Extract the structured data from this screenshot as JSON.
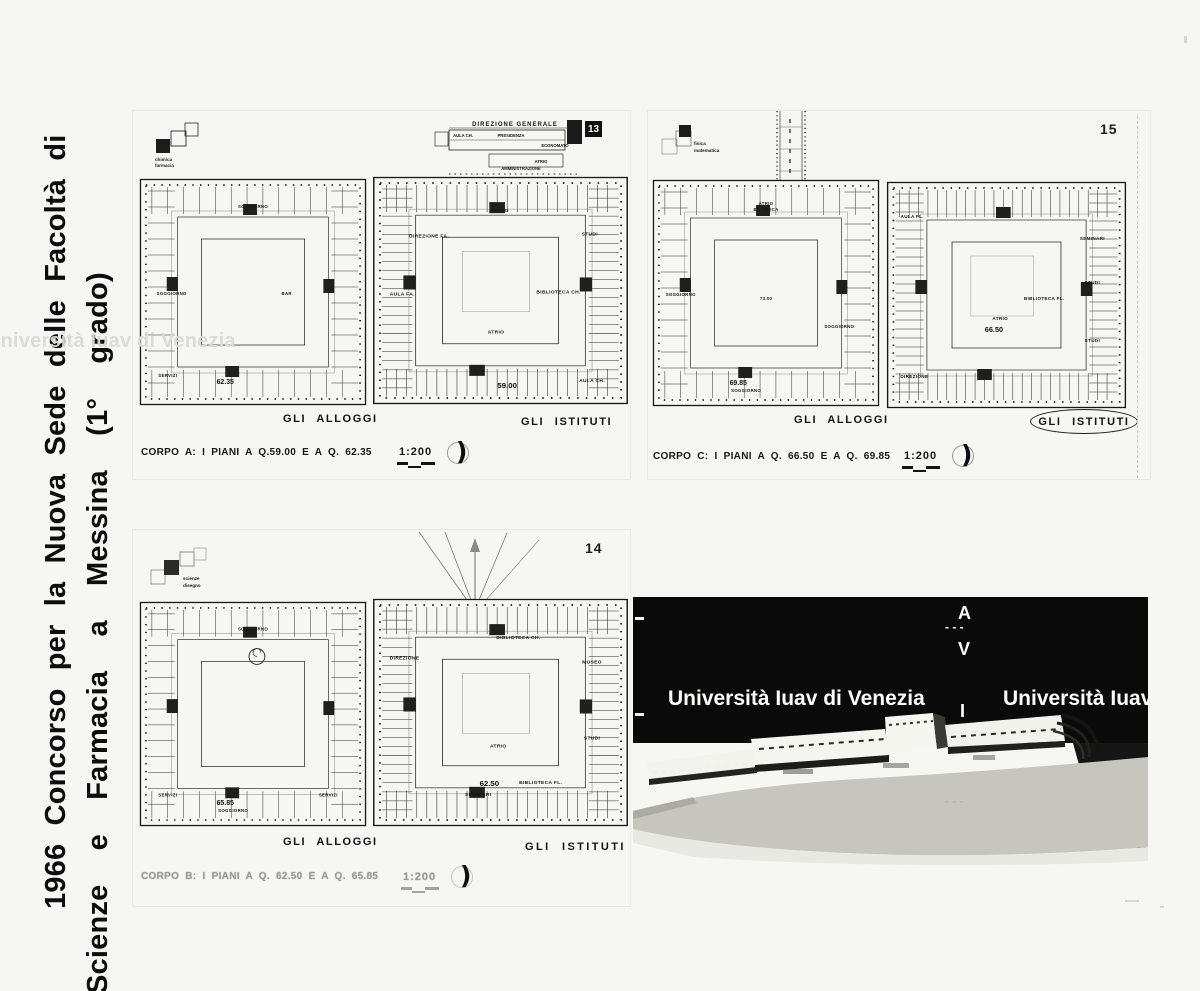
{
  "title_column": {
    "line1": "1966 Concorso per la Nuova Sede delle Facoltà di",
    "line2": "Scienze e Farmacia a Messina (1° grado)"
  },
  "watermark": {
    "line": "Università Iuav di Venezia",
    "letter_a": "A",
    "letter_v": "V",
    "letter_i": "I",
    "dashes": "- - -"
  },
  "glyphs": {
    "north_crescent": ")"
  },
  "panels": [
    {
      "number": "13",
      "key_label_1": "chimica",
      "key_label_2": "farmacia",
      "annex": {
        "title": "DIREZIONE GENERALE",
        "room_1": "AULA CH.",
        "room_2": "PRESIDENZA",
        "room_3": "ECONOMATO",
        "room_4": "ATRIO",
        "room_5": "AMMINISTRAZIONE"
      },
      "caption": "CORPO A: I PIANI A Q.59.00 E A Q. 62.35",
      "scale": "1:200",
      "plans": [
        {
          "label": "GLI ALLOGGI",
          "dense": false,
          "elev": "62.35",
          "elev_x": 88,
          "elev_y": 207,
          "labels": [
            {
              "t": "SOGGIORNO",
              "x": 116,
              "y": 31
            },
            {
              "t": "SOGGIORNO",
              "x": 34,
              "y": 118
            },
            {
              "t": "BAR",
              "x": 150,
              "y": 118
            },
            {
              "t": "SERVIZI",
              "x": 30,
              "y": 200
            }
          ]
        },
        {
          "label": "GLI ISTITUTI",
          "dense": true,
          "inner": true,
          "elev": "59.00",
          "elev_x": 122,
          "elev_y": 212,
          "labels": [
            {
              "t": "ATRIO",
              "x": 116,
              "y": 37
            },
            {
              "t": "AULA FA.",
              "x": 28,
              "y": 120
            },
            {
              "t": "DIREZIONE FA.",
              "x": 52,
              "y": 62
            },
            {
              "t": "BIBLIOTECA CH.",
              "x": 168,
              "y": 118
            },
            {
              "t": "AULA CH.",
              "x": 198,
              "y": 206
            },
            {
              "t": "ATRIO",
              "x": 112,
              "y": 158
            },
            {
              "t": "STUDI",
              "x": 196,
              "y": 60
            }
          ]
        }
      ]
    },
    {
      "number": "15",
      "key_label_1": "fisica",
      "key_label_2": "matematica",
      "caption": "CORPO C: I PIANI A Q. 66.50 E A Q. 69.85",
      "scale": "1:200",
      "plans": [
        {
          "label": "GLI ALLOGGI",
          "dense": false,
          "elev": "69.85",
          "elev_x": 88,
          "elev_y": 207,
          "court": "73.00",
          "labels": [
            {
              "t": "ATRIO",
              "x": 116,
              "y": 27
            },
            {
              "t": "BOTANICA",
              "x": 116,
              "y": 33
            },
            {
              "t": "SOGGIORNO",
              "x": 30,
              "y": 118
            },
            {
              "t": "SOGGIORNO",
              "x": 190,
              "y": 150
            },
            {
              "t": "SOGGIORNO",
              "x": 96,
              "y": 214
            }
          ]
        },
        {
          "label": "GLI ISTITUTI",
          "dense": true,
          "inner": true,
          "elev": "66.50",
          "elev_x": 104,
          "elev_y": 152,
          "labels": [
            {
              "t": "AULA FL.",
              "x": 26,
              "y": 38
            },
            {
              "t": "SEMINARI",
              "x": 198,
              "y": 60
            },
            {
              "t": "STUDI",
              "x": 198,
              "y": 104
            },
            {
              "t": "ATRIO",
              "x": 110,
              "y": 140
            },
            {
              "t": "BIBLIOTECA FL.",
              "x": 152,
              "y": 120
            },
            {
              "t": "DIREZIONE",
              "x": 28,
              "y": 198
            },
            {
              "t": "STUDI",
              "x": 198,
              "y": 162
            }
          ]
        }
      ]
    },
    {
      "number": "14",
      "key_label_1": "scienze",
      "key_label_2": "disegno",
      "caption": "CORPO B: I PIANI A Q. 62.50 E A Q. 65.85",
      "scale": "1:200",
      "plans": [
        {
          "label": "GLI ALLOGGI",
          "dense": false,
          "circle": true,
          "elev": "65.85",
          "elev_x": 88,
          "elev_y": 207,
          "labels": [
            {
              "t": "SOGGIORNO",
              "x": 116,
              "y": 31
            },
            {
              "t": "SERVIZI",
              "x": 30,
              "y": 198
            },
            {
              "t": "SOGGIORNO",
              "x": 96,
              "y": 214
            },
            {
              "t": "SERVIZI",
              "x": 192,
              "y": 198
            }
          ]
        },
        {
          "label": "GLI ISTITUTI",
          "dense": true,
          "inner": true,
          "elev": "62.50",
          "elev_x": 106,
          "elev_y": 188,
          "labels": [
            {
              "t": "BIBLIOTECA CH.",
              "x": 132,
              "y": 42
            },
            {
              "t": "MUSEO",
              "x": 198,
              "y": 66
            },
            {
              "t": "DIREZIONE",
              "x": 30,
              "y": 62
            },
            {
              "t": "ATRIO",
              "x": 114,
              "y": 150
            },
            {
              "t": "SEMINARI",
              "x": 96,
              "y": 198
            },
            {
              "t": "STUDI",
              "x": 198,
              "y": 142
            },
            {
              "t": "BIBLIOTECA FL.",
              "x": 152,
              "y": 186
            }
          ]
        }
      ]
    }
  ]
}
